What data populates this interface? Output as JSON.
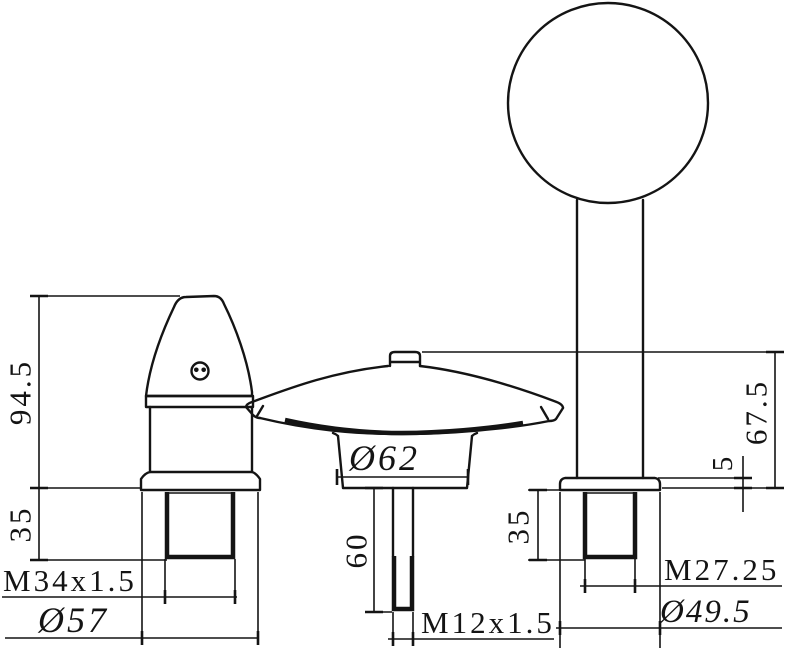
{
  "drawing": {
    "kind": "faucet-3-hole-set-dimension-drawing",
    "colors": {
      "line": "#141414",
      "background": "#ffffff"
    },
    "dims": {
      "left": {
        "height": "94.5",
        "thread_length": "35",
        "thread_spec": "M34x1.5",
        "base_diameter": "Ø57"
      },
      "spout": {
        "body_diameter": "Ø62",
        "shank_length": "60",
        "thread_spec": "M12x1.5"
      },
      "right": {
        "height": "67.5",
        "flange_height": "5",
        "thread_length": "35",
        "thread_spec": "M27.25",
        "base_diameter": "Ø49.5"
      }
    }
  }
}
